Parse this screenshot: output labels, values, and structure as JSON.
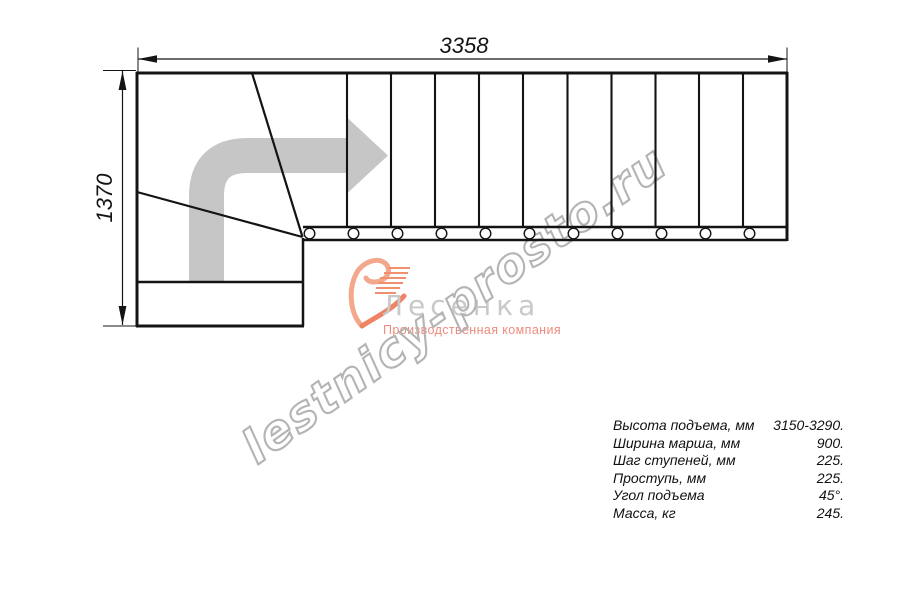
{
  "drawing": {
    "type": "staircase-plan-top-view",
    "outline_color": "#141414",
    "direction_arrow_color": "#c6c6c6",
    "tread_lines_x": [
      347,
      391,
      435,
      479,
      523,
      567.5,
      611.5,
      655.5,
      699,
      743
    ],
    "baluster_circles_x": [
      309.5,
      353.5,
      397.5,
      441.5,
      485.5,
      529.5,
      573.5,
      617.5,
      661.5,
      705.5,
      749.5
    ]
  },
  "dimensions": {
    "width_label": "3358",
    "height_label": "1370"
  },
  "watermark": {
    "text": "lestnicy-prosto.ru",
    "color": "#b4b4b4"
  },
  "logo": {
    "name": "Лесенка",
    "tagline": "Производственная компания",
    "name_color": "#c9c9c9",
    "tagline_color": "#ee8b7d",
    "mark_color": "#f0906f"
  },
  "specs": {
    "rows": [
      {
        "label": "Высота подъема, мм",
        "value": "3150-3290."
      },
      {
        "label": "Ширина марша, мм",
        "value": "900."
      },
      {
        "label": "Шаг ступеней, мм",
        "value": "225."
      },
      {
        "label": "Проступь, мм",
        "value": "225."
      },
      {
        "label": "Угол подъема",
        "value": "45°."
      },
      {
        "label": "Масса, кг",
        "value": "245."
      }
    ]
  }
}
